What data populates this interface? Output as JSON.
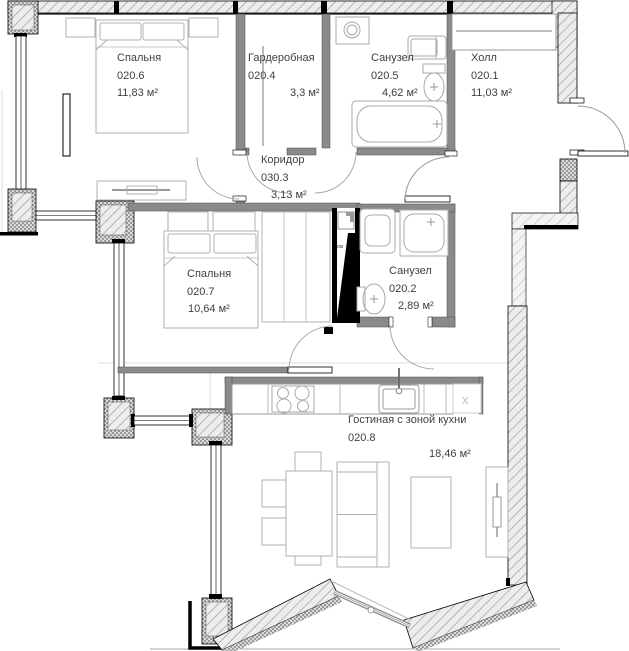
{
  "rooms": [
    {
      "name": "Спальня",
      "number": "020.6",
      "area": "11,83 м²"
    },
    {
      "name": "Гардеробная",
      "number": "020.4",
      "area": "3,3 м²"
    },
    {
      "name": "Санузел",
      "number": "020.5",
      "area": "4,62 м²"
    },
    {
      "name": "Холл",
      "number": "020.1",
      "area": "11,03 м²"
    },
    {
      "name": "Коридор",
      "number": "030.3",
      "area": "3,13 м²"
    },
    {
      "name": "Спальня",
      "number": "020.7",
      "area": "10,64 м²"
    },
    {
      "name": "Санузел",
      "number": "020.2",
      "area": "2,89 м²"
    },
    {
      "name": "Гостиная с зоной кухни",
      "number": "020.8",
      "area": "18,46 м²"
    }
  ],
  "annotations": {
    "shaft_label": "см",
    "kitchen_marker": "х"
  },
  "colors": {
    "wall_interior": "#8a8a8a",
    "line_black": "#000000",
    "furniture_stroke": "#b0b0b0",
    "label_text": "#3f3f3f"
  }
}
